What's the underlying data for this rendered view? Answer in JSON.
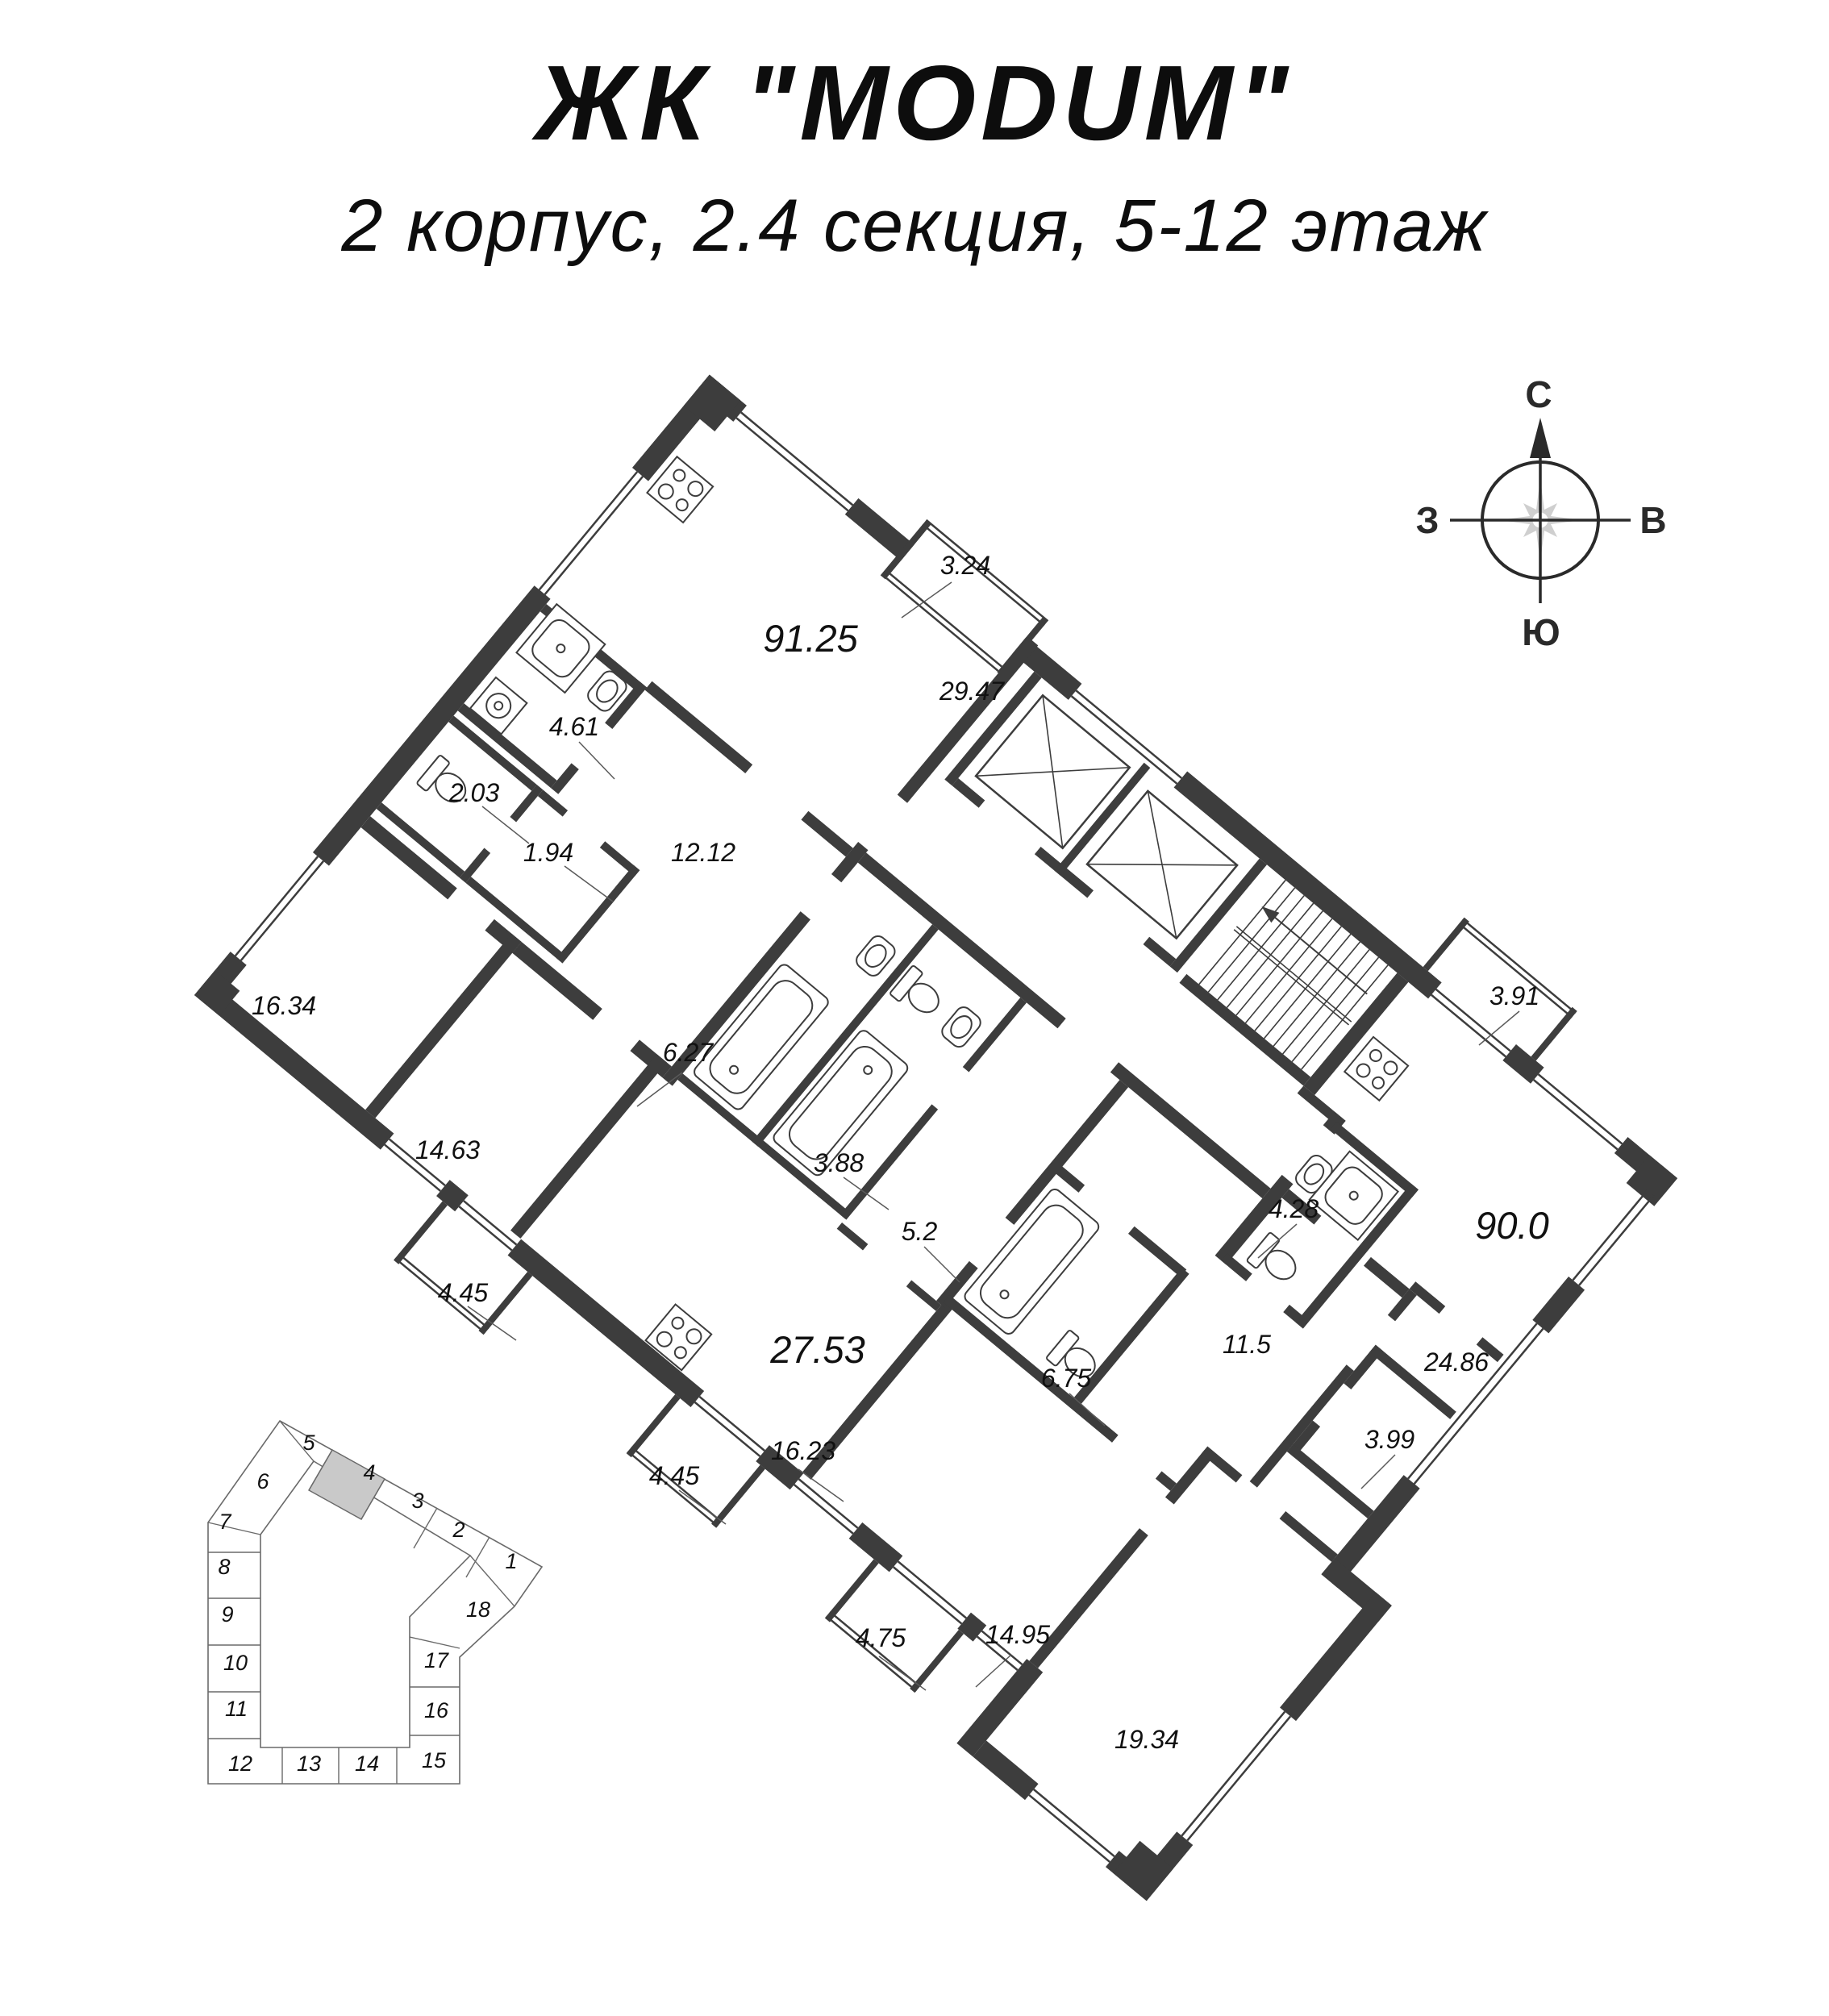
{
  "title": "ЖК \"MODUM\"",
  "subtitle": "2 корпус, 2.4 секция, 5-12 этаж",
  "compass": {
    "north": "С",
    "east": "В",
    "south": "Ю",
    "west": "З"
  },
  "plan": {
    "room_areas": [
      "3.24",
      "91.25",
      "29.47",
      "4.61",
      "2.03",
      "1.94",
      "12.12",
      "16.34",
      "6.27",
      "14.63",
      "3.88",
      "5.2",
      "4.45",
      "27.53",
      "6.75",
      "16.23",
      "4.45",
      "4.75",
      "14.95",
      "19.34",
      "11.5",
      "4.28",
      "24.86",
      "3.99",
      "90.0",
      "3.91"
    ]
  },
  "site_plan": {
    "sections": [
      "1",
      "2",
      "3",
      "4",
      "5",
      "6",
      "7",
      "8",
      "9",
      "10",
      "11",
      "12",
      "13",
      "14",
      "15",
      "16",
      "17",
      "18"
    ],
    "highlighted_section": "4"
  },
  "colors": {
    "wall": "#3d3d3d",
    "section_highlight": "#c9c9c9",
    "compass_star": "#cfcfcf"
  }
}
